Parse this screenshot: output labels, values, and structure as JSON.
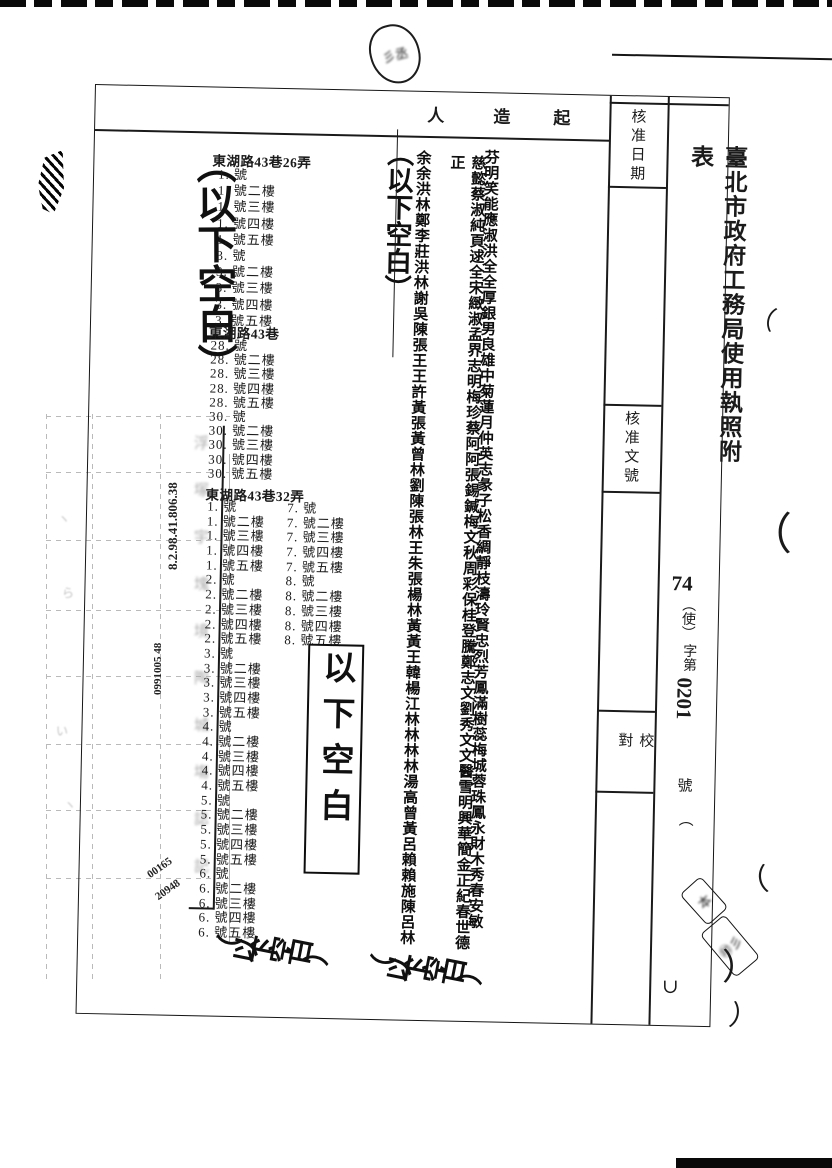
{
  "form": {
    "title": "臺北市政府工務局使用執照附表",
    "doc_no_year": "74",
    "doc_no_type": "（使）",
    "doc_no_mid": "字第",
    "doc_no_digits": "0201",
    "doc_no_suffix": "號",
    "doc_no_trailing_paren": "（",
    "header_chars": [
      "人",
      "造",
      "起"
    ],
    "approval_date_label": "核准日期",
    "approval_doc_label": "核准文號",
    "proofread_label": "校對"
  },
  "addresses": {
    "block1_header": "東湖路43巷26弄",
    "block1_lines": [
      "1. 號",
      "1. 號二樓",
      "1. 號三樓",
      "1. 號四樓",
      "1. 號五樓",
      "3. 號",
      "3. 號二樓",
      "3. 號三樓",
      "3. 號四樓",
      "3. 號五樓"
    ],
    "block2_header": "東湖路43巷",
    "block2_lines": [
      "28. 號",
      "28. 號二樓",
      "28. 號三樓",
      "28. 號四樓",
      "28. 號五樓",
      "30. 號",
      "30. 號二樓",
      "30. 號三樓",
      "30. 號四樓",
      "30. 號五樓"
    ],
    "block3_header": "東湖路43巷32弄",
    "block3_left_lines": [
      "1. 號",
      "1. 號二樓",
      "1. 號三樓",
      "1. 號四樓",
      "1. 號五樓",
      "2. 號",
      "2. 號二樓",
      "2. 號三樓",
      "2. 號四樓",
      "2. 號五樓",
      "3. 號",
      "3. 號二樓",
      "3. 號三樓",
      "3. 號四樓",
      "3. 號五樓",
      "4. 號",
      "4. 號二樓",
      "4. 號三樓",
      "4. 號四樓",
      "4. 號五樓",
      "5. 號",
      "5. 號二樓",
      "5. 號三樓",
      "5. 號四樓",
      "5. 號五樓",
      "6. 號",
      "6. 號二樓",
      "6. 號三樓",
      "6. 號四樓",
      "6. 號五樓"
    ],
    "block3_right_lines": [
      "7. 號",
      "7. 號二樓",
      "7. 號三樓",
      "7. 號四樓",
      "7. 號五樓",
      "8. 號",
      "8. 號二樓",
      "8. 號三樓",
      "8. 號四樓",
      "8. 號五樓"
    ]
  },
  "names": {
    "surname_column": "余余洪林鄭李莊洪林謝吳陳張王王許黃張黃曾林劉陳張林王朱張楊林黃黃王韓楊江林林林林湯高曾黃呂賴賴施陳呂林",
    "middle_column": "慈懿蔡淑純頁逑全宋緻淑孟界志明梅珍蔡阿阿張錫鍼梅文秋周彩保桂登騰鄭志文劉秀文文醫雪明興華簡金正紀春世德正",
    "given_column": "芬明笑能應淑洪全全厚銀男良雄中菊蓮月仲英志彖子松香綢靜枝濤玲賢忠烈芳鳳滿樹蕊梅城蓉珠鳳永財木秀春安敏"
  },
  "blank_notes": {
    "left_large": "（以下空白）",
    "middle_crossed": "（以下空白）",
    "boxed": "以下空白",
    "bottom_addresses_chars": [
      "（",
      "以",
      "下",
      "空",
      "白",
      "）"
    ],
    "bottom_names_chars": [
      "（",
      "以",
      "下",
      "空",
      "白",
      "）"
    ]
  },
  "handwritten": {
    "annotation_numbers_1": "8.2.98.41.806.38",
    "annotation_numbers_2": "0991005 48",
    "annotation_numbers_3": "00165",
    "annotation_numbers_4": "20948"
  },
  "bleedthrough": {
    "glyph_column": [
      "浮",
      "塚",
      "宇",
      "塊",
      "境",
      "陶",
      "城",
      "塲",
      "誌",
      "記"
    ],
    "cell_marks": [
      "ヽ",
      "ら",
      "い",
      "ヽ"
    ]
  },
  "stray_marks": {
    "m1": "（",
    "m2": "（",
    "m3": "（",
    "m4": "）",
    "m5": "∪",
    "m6": "）",
    "stamp_scribble_top": "彡丞",
    "stamp_scribble_a": "本",
    "stamp_scribble_b": "㊞彡"
  }
}
